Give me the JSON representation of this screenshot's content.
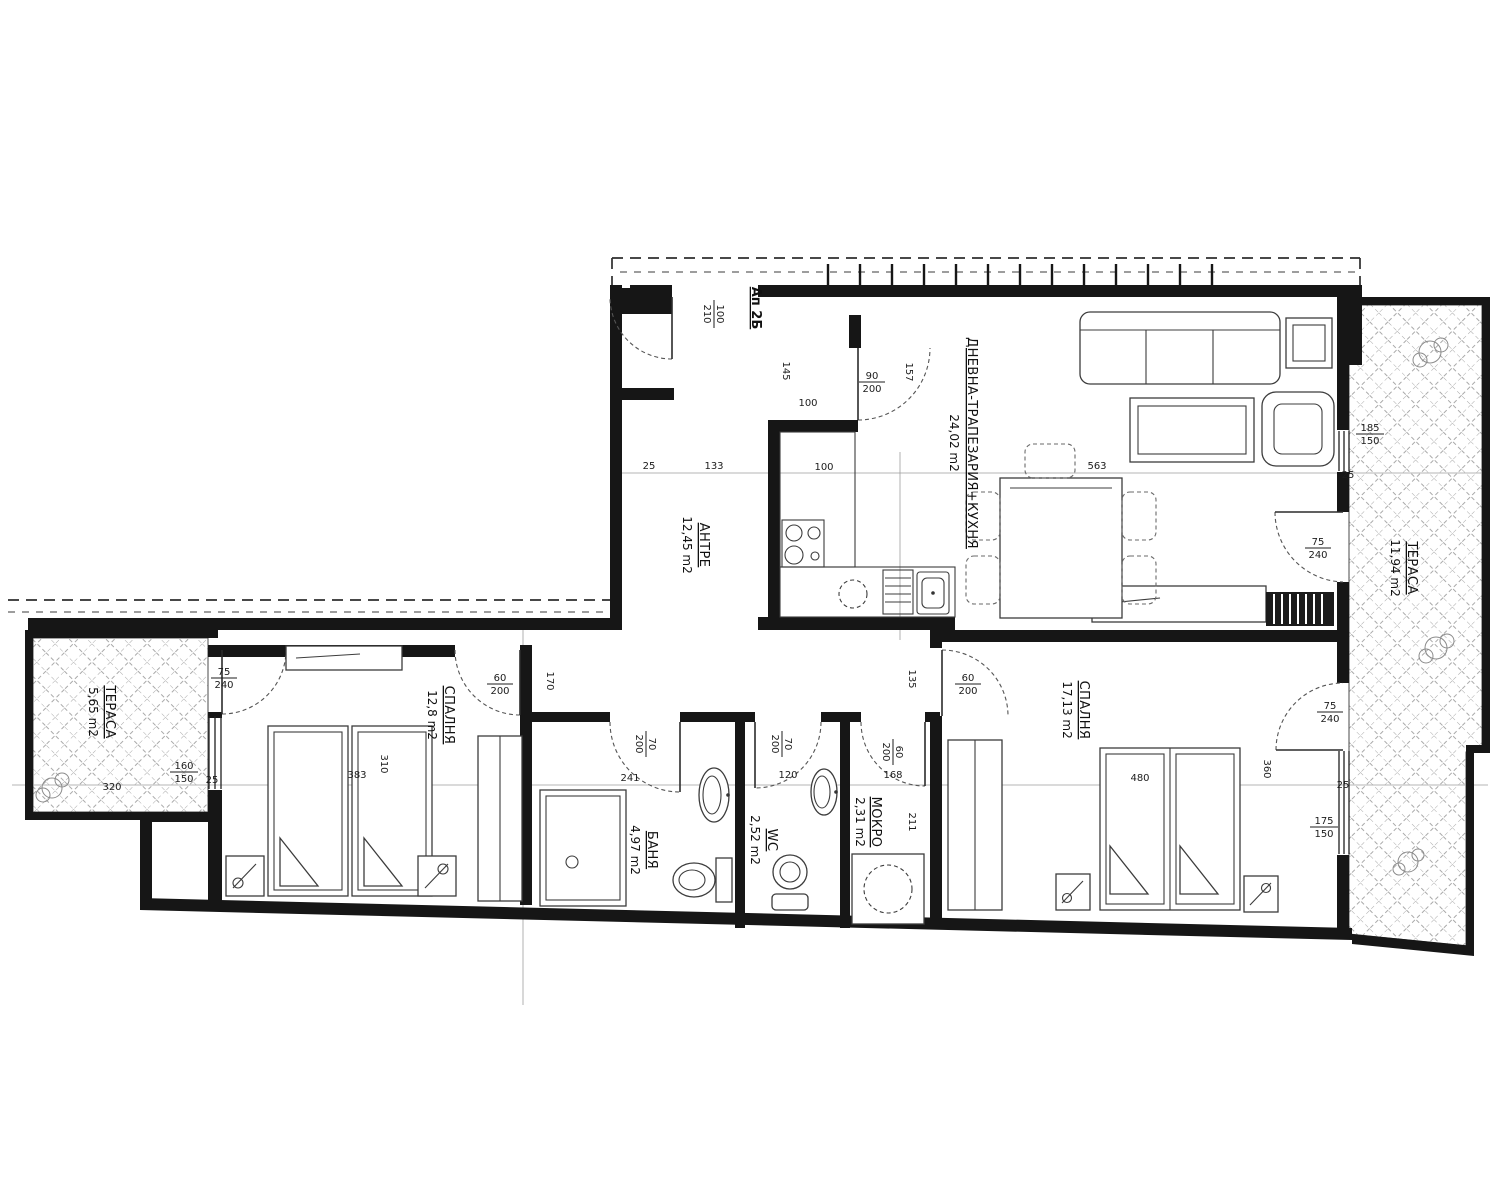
{
  "plan": {
    "entrance": {
      "label": "Ап 2Б",
      "size": {
        "w": "100",
        "h": "210"
      }
    },
    "rooms": [
      {
        "id": "antre",
        "name": "АНТРЕ",
        "area": "12,45 m2"
      },
      {
        "id": "living",
        "name": "ДНЕВНА-ТРАПЕЗАРИЯ+КУХНЯ",
        "area": "24,02 m2"
      },
      {
        "id": "bedroom-left",
        "name": "СПАЛНЯ",
        "area": "12,8 m2"
      },
      {
        "id": "bedroom-right",
        "name": "СПАЛНЯ",
        "area": "17,13 m2"
      },
      {
        "id": "bath",
        "name": "БАНЯ",
        "area": "4,97 m2"
      },
      {
        "id": "wc",
        "name": "WC",
        "area": "2,52 m2"
      },
      {
        "id": "mokro",
        "name": "МОКРО",
        "area": "2,31 m2"
      },
      {
        "id": "terrace-left",
        "name": "ТЕРАСА",
        "area": "5,65 m2"
      },
      {
        "id": "terrace-right",
        "name": "ТЕРАСА",
        "area": "11,94 m2"
      }
    ],
    "doors": {
      "kitchen": {
        "w": "90",
        "h": "200"
      },
      "bath": {
        "w": "70",
        "h": "200"
      },
      "wc": {
        "w": "70",
        "h": "200"
      },
      "mokro": {
        "w": "60",
        "h": "200"
      },
      "bedroom_left": {
        "w": "60",
        "h": "200"
      },
      "bedroom_right": {
        "w": "60",
        "h": "200"
      },
      "terrace_left": {
        "w": "75",
        "h": "240"
      },
      "terrace_living": {
        "w": "75",
        "h": "240"
      },
      "terrace_bedroom": {
        "w": "75",
        "h": "240"
      }
    },
    "windows": {
      "bedroom_left": {
        "w": "160",
        "h": "150"
      },
      "living": {
        "w": "185",
        "h": "150"
      },
      "bedroom_right": {
        "w": "175",
        "h": "150"
      }
    },
    "dims": {
      "v25": "25",
      "v100": "100",
      "v133": "133",
      "v145": "145",
      "v157": "157",
      "v563": "563",
      "v320": "320",
      "v383": "383",
      "v310": "310",
      "v170": "170",
      "v480": "480",
      "v360": "360",
      "v135": "135",
      "v211": "211",
      "v168": "168",
      "v120": "120",
      "v241": "241"
    }
  }
}
